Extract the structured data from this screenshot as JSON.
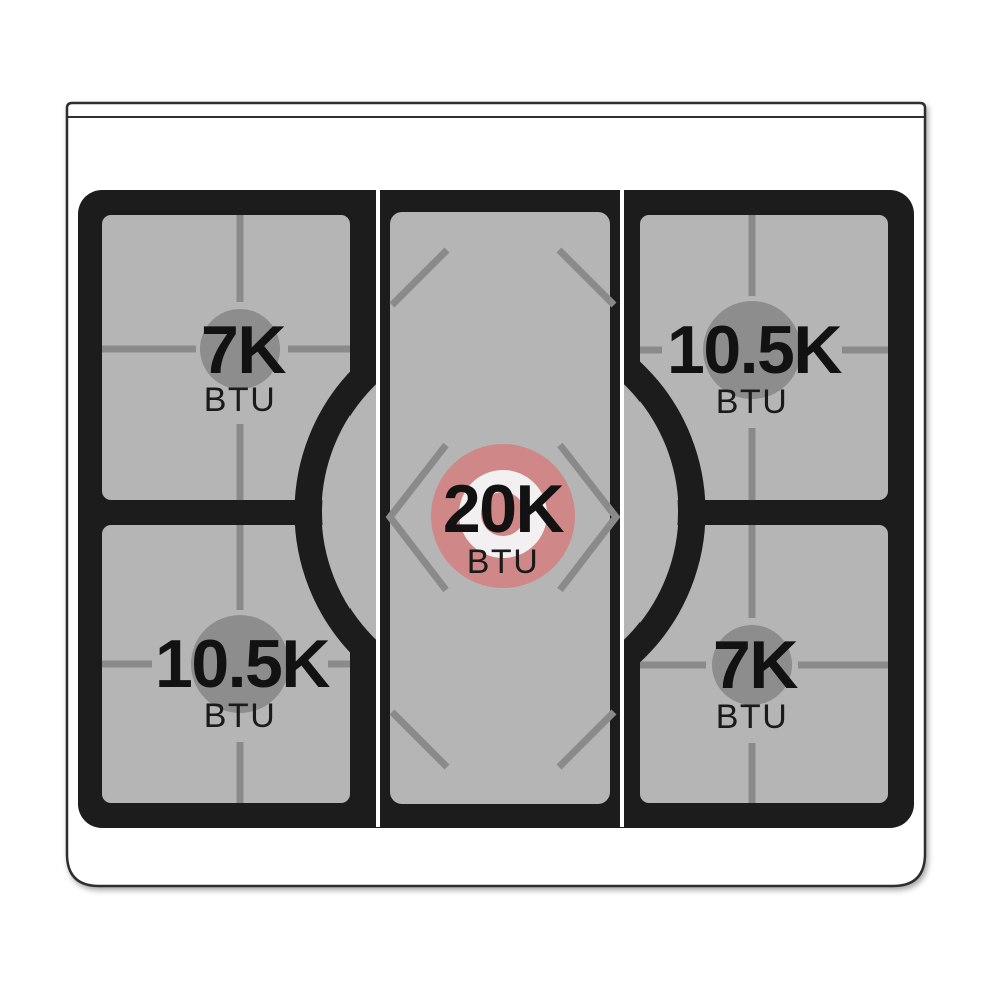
{
  "diagram": {
    "name": "Gas range cooktop burner layout diagram",
    "unit_label": "BTU"
  },
  "burners": {
    "top_left": {
      "power": "7K",
      "unit": "BTU"
    },
    "top_right": {
      "power": "10.5K",
      "unit": "BTU"
    },
    "center": {
      "power": "20K",
      "unit": "BTU"
    },
    "bottom_left": {
      "power": "10.5K",
      "unit": "BTU"
    },
    "bottom_right": {
      "power": "7K",
      "unit": "BTU"
    }
  },
  "colors": {
    "body_white": "#ffffff",
    "outline": "#2f2f2f",
    "cooktop_black": "#1c1c1c",
    "panel_gray": "#b5b5b5",
    "grate_gray": "#8a8a8a",
    "burner_circle_gray": "#8d8d8d",
    "center_burner_pink": "#d08787",
    "center_ring_white": "#f2f0f0"
  }
}
